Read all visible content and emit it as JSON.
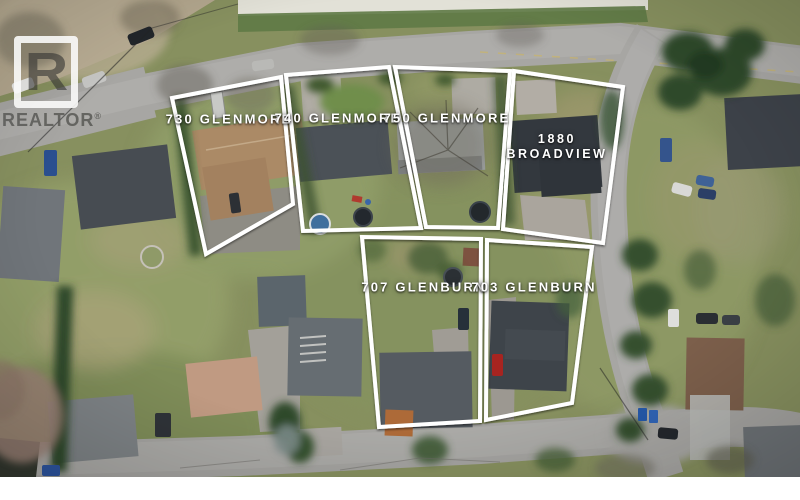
{
  "watermark": {
    "logo_letter": "R",
    "brand": "REALTOR",
    "reg": "®"
  },
  "lots": [
    {
      "label": "730 GLENMORE"
    },
    {
      "label": "740 GLENMORE"
    },
    {
      "label": "750 GLENMORE"
    },
    {
      "line1": "1880",
      "line2": "BROADVIEW"
    },
    {
      "label": "707 GLENBURN"
    },
    {
      "label": "703 GLENBURN"
    }
  ],
  "colors": {
    "lot_outline": "#ffffff",
    "label_text": "#ffffff"
  }
}
